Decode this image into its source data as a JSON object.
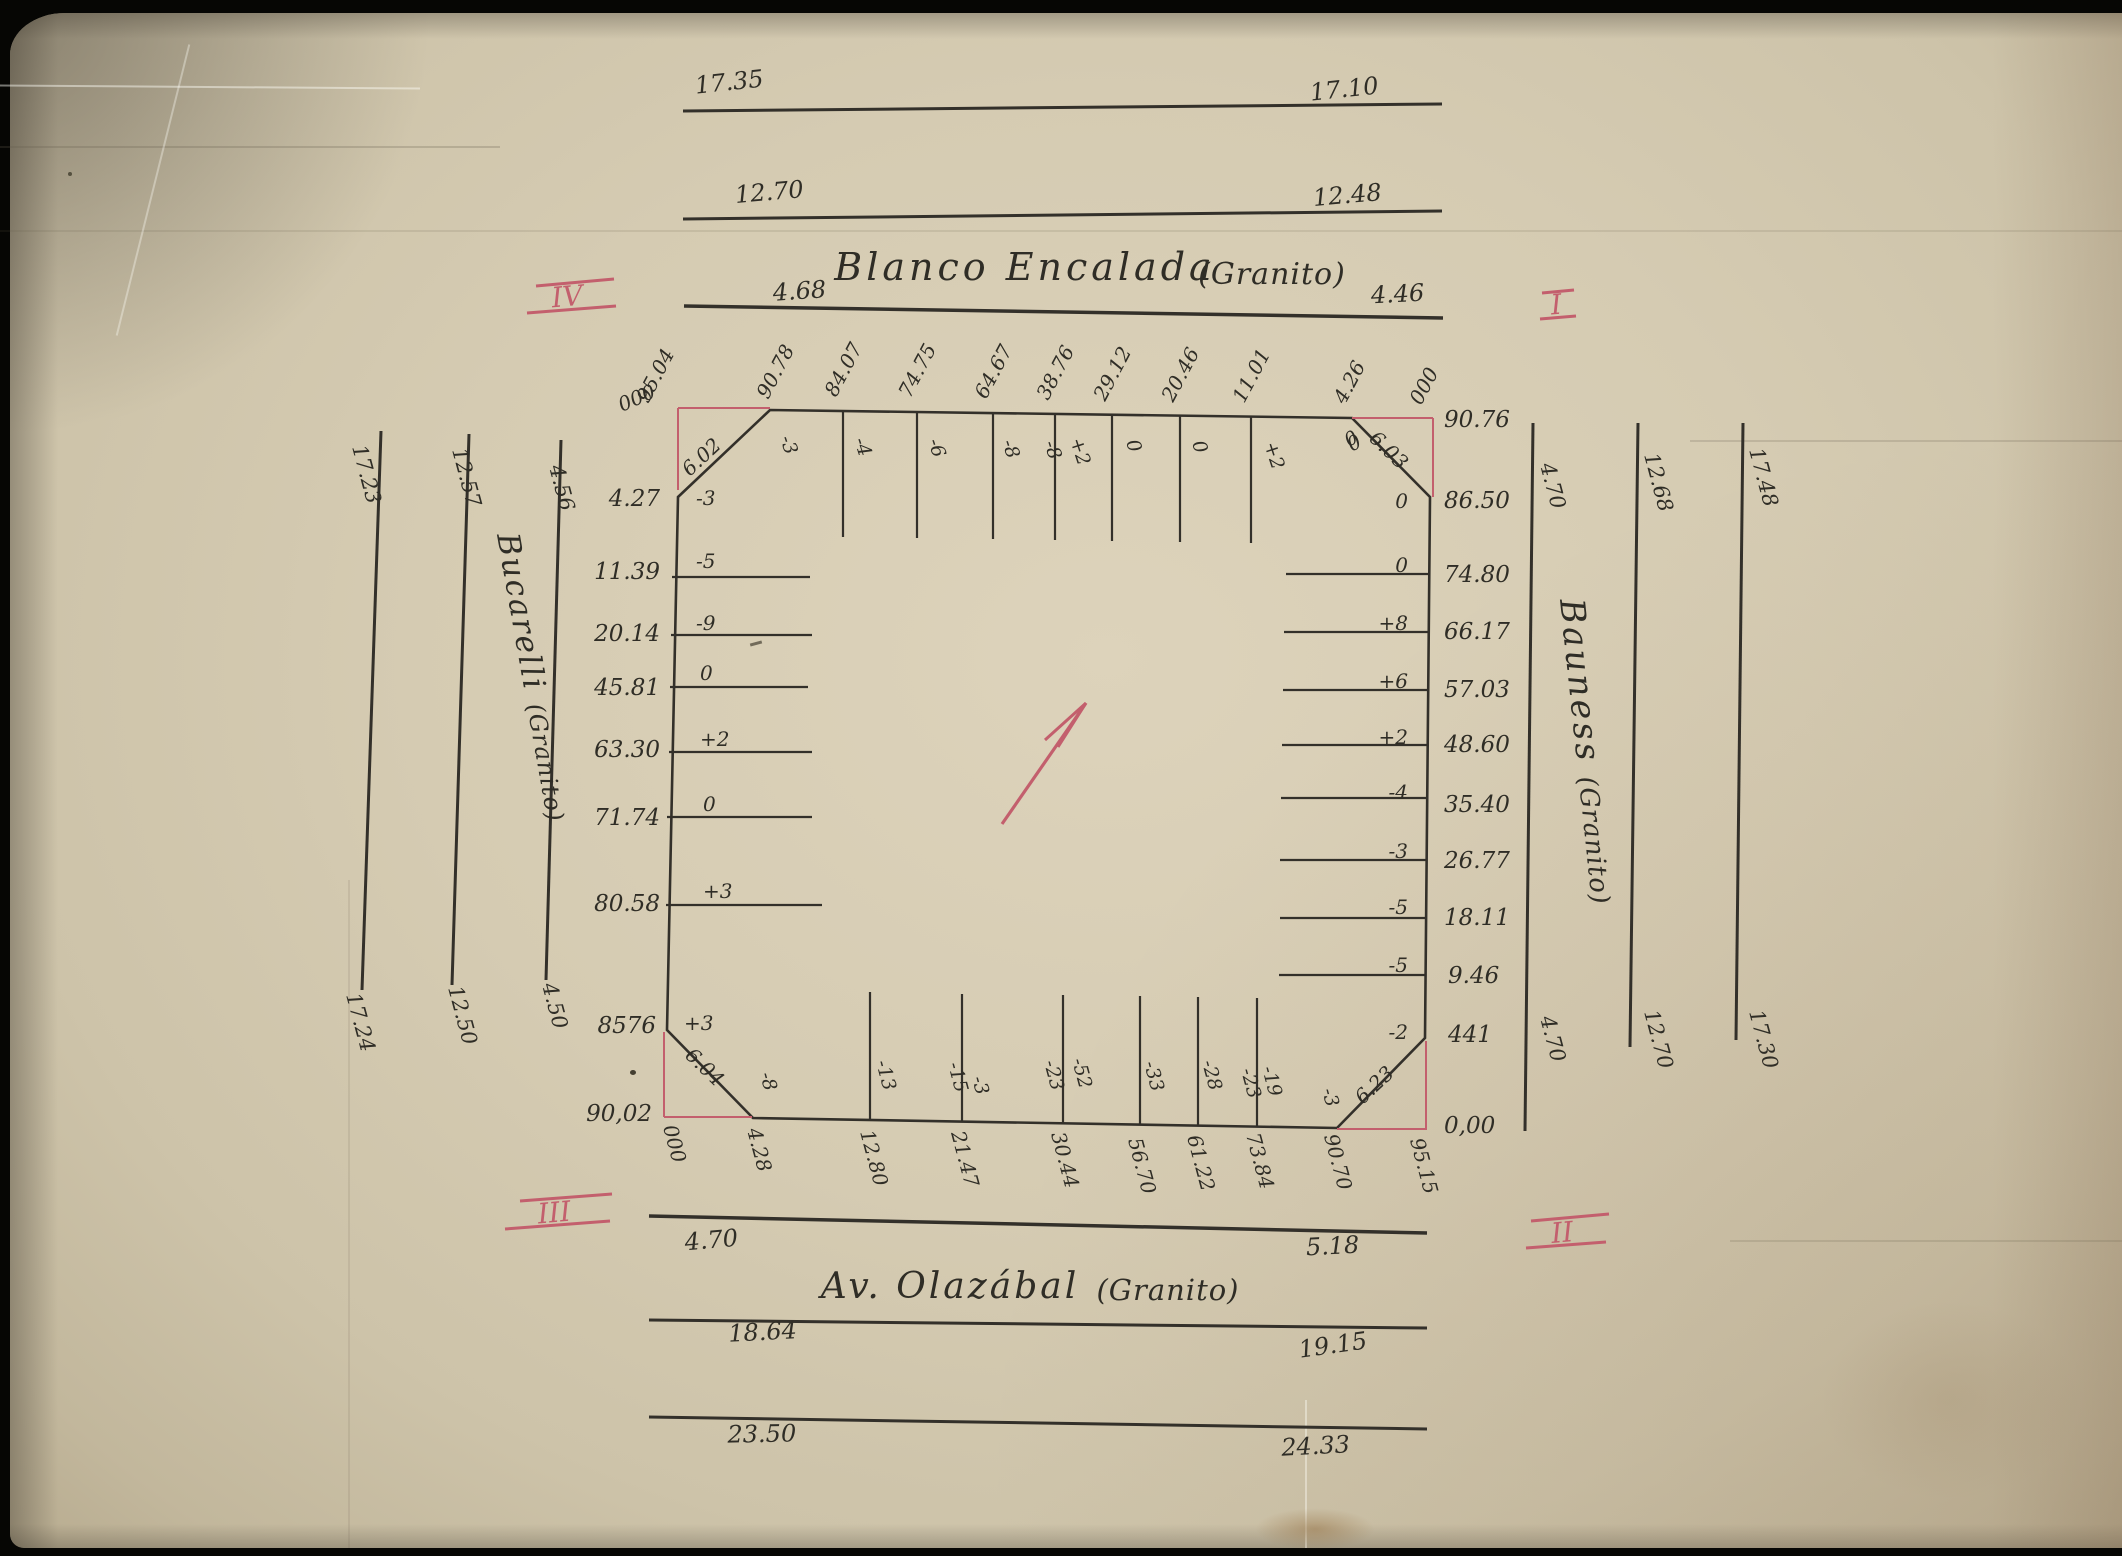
{
  "colors": {
    "ink": "#33302a",
    "pink": "#c35f6d",
    "paper": "#d5cbb2"
  },
  "markers": {
    "tl": "IV",
    "tr": "I",
    "bl": "III",
    "br": "II"
  },
  "streets": {
    "top": {
      "name": "Blanco Encalada",
      "material": "(Granito)",
      "rows": [
        [
          "17.35",
          "17.10"
        ],
        [
          "12.70",
          "12.48"
        ],
        [
          "4.68",
          "4.46"
        ]
      ]
    },
    "bottom": {
      "name": "Av. Olazábal",
      "material": "(Granito)",
      "rows": [
        [
          "4.70",
          "5.18"
        ],
        [
          "18.64",
          "19.15"
        ],
        [
          "23.50",
          "24.33"
        ]
      ]
    },
    "left": {
      "name": "Bucarelli",
      "material": "(Granito)",
      "top_labels": [
        "17.23",
        "12.57",
        "4.56"
      ],
      "bottom_labels": [
        "17.24",
        "12.50",
        "4.50"
      ]
    },
    "right": {
      "name": "Bauness",
      "material": "(Granito)",
      "top_labels": [
        "4.70",
        "12.68",
        "17.48"
      ],
      "bottom_labels": [
        "4.70",
        "12.70",
        "17.30"
      ]
    }
  },
  "parcel": {
    "chamfers": {
      "tl": "6.02",
      "tr": "6.03",
      "bl": "6.04",
      "br": "6.23"
    },
    "top": {
      "distances": [
        "95.04",
        "90.78",
        "84.07",
        "74.75",
        "64.67",
        "38.76",
        "29.12",
        "20.46",
        "11.01",
        "4.26",
        "000"
      ],
      "offsets": [
        "-3",
        "-4",
        "-6",
        "-8",
        "-8",
        "+2",
        "0",
        "0",
        "+2",
        "0"
      ]
    },
    "left": {
      "distances": [
        "000",
        "4.27",
        "11.39",
        "20.14",
        "45.81",
        "63.30",
        "71.74",
        "80.58",
        "8576",
        "90,02"
      ],
      "offsets": [
        "-3",
        "-5",
        "-9",
        "0",
        "+2",
        "0",
        "+3",
        "+3"
      ]
    },
    "right": {
      "distances": [
        "90.76",
        "86.50",
        "74.80",
        "66.17",
        "57.03",
        "48.60",
        "35.40",
        "26.77",
        "18.11",
        "9.46",
        "441",
        "0,00"
      ],
      "offsets": [
        "0",
        "0",
        "0",
        "+8",
        "+6",
        "+2",
        "-4",
        "-3",
        "-5",
        "-5",
        "-2"
      ]
    },
    "bottom": {
      "distances": [
        "000",
        "4.28",
        "12.80",
        "21.47",
        "30.44",
        "56.70",
        "61.22",
        "73.84",
        "90.70",
        "95.15"
      ],
      "offsets": [
        "-8",
        "-13",
        "-15",
        "-3",
        "-23",
        "-52",
        "-33",
        "-28",
        "-23",
        "-19",
        "-3"
      ]
    }
  }
}
